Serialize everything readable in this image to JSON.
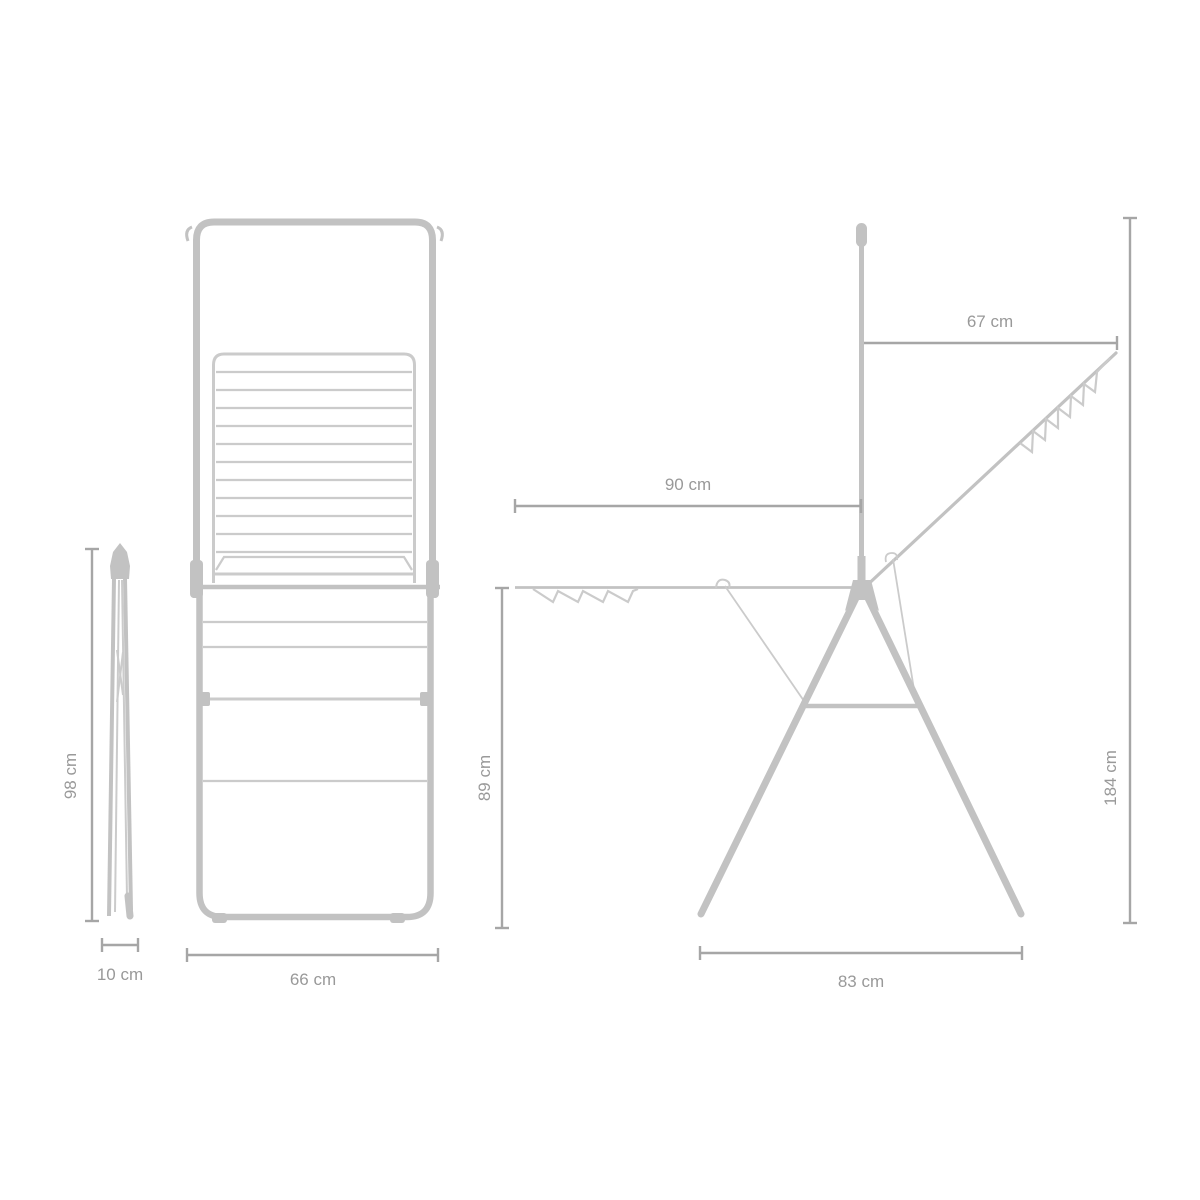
{
  "canvas": {
    "width": 1200,
    "height": 1200,
    "background": "#ffffff"
  },
  "colors": {
    "structure": "#c2c2c2",
    "structure_light": "#cbcbcb",
    "dimension_line": "#a6a6a6",
    "label_text": "#999999"
  },
  "views": {
    "folded": {
      "height_label": "98 cm",
      "depth_label": "10 cm"
    },
    "front": {
      "width_label": "66 cm"
    },
    "side": {
      "left_wing_label": "90 cm",
      "right_wing_label": "67 cm",
      "drying_height_label": "89 cm",
      "total_height_label": "184 cm",
      "base_width_label": "83 cm"
    }
  }
}
